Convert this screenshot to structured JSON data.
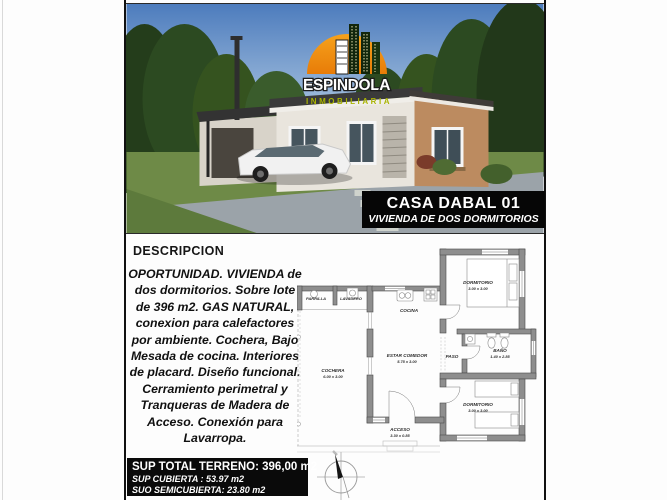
{
  "logo": {
    "name": "ESPINDOLA",
    "tagline": "INMOBILIARIA"
  },
  "banner": {
    "title": "CASA DABAL 01",
    "subtitle": "VIVIENDA DE DOS DORMITORIOS"
  },
  "description": {
    "heading": "DESCRIPCION",
    "body": "OPORTUNIDAD. VIVIENDA de dos dormitorios. Sobre lote de 396 m2. GAS NATURAL, conexion para calefactores por ambiente. Cochera, Bajo Mesada de cocina. Interiores de placard. Diseño funcional. Cerramiento perimetral y Tranqueras de Madera de Acceso. Conexión para Lavarropa."
  },
  "floorplan": {
    "rooms": {
      "parrilla": {
        "name": "PARRILLA"
      },
      "lavadero": {
        "name": "LAVADERO"
      },
      "cocina": {
        "name": "COCINA"
      },
      "dormitorio1": {
        "name": "DORMITORIO",
        "dims": "3.00 x 3.00"
      },
      "cochera": {
        "name": "COCHERA",
        "dims": "6.00 x 3.00"
      },
      "estar": {
        "name": "ESTAR COMEDOR",
        "dims": "5.75 x 3.00"
      },
      "paso": {
        "name": "PASO"
      },
      "bano": {
        "name": "BAÑO",
        "dims": "1.40 x 2.85"
      },
      "dormitorio2": {
        "name": "DORMITORIO",
        "dims": "3.00 x 3.00"
      },
      "acceso": {
        "name": "ACCESO",
        "dims": "3.30 x 0.85"
      }
    }
  },
  "summary": {
    "terreno": "SUP TOTAL TERRENO: 396,00 m2",
    "cubierta": "SUP CUBIERTA : 53.97 m2",
    "semicubierta": "SUO SEMICUBIERTA: 23.80 m2"
  },
  "colors": {
    "banner_bg": "#060606",
    "logo_orange": "#ef8c12",
    "logo_green": "#a9b400",
    "wall_gray": "#8e8e8e",
    "sky": "#5a87c5",
    "grass": "#6e8a47"
  }
}
